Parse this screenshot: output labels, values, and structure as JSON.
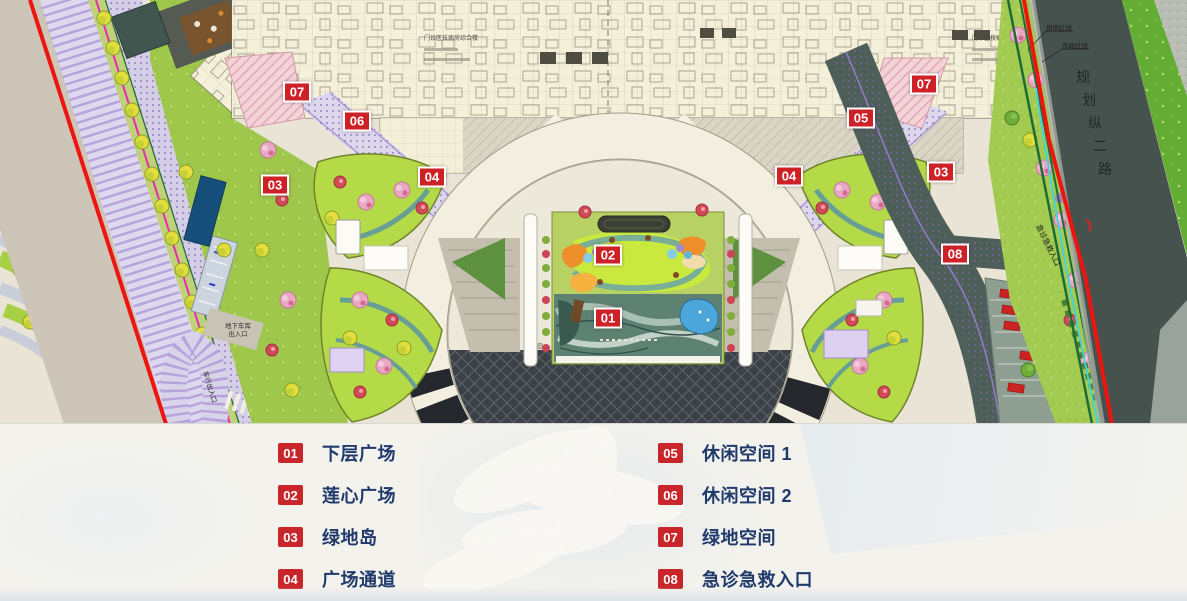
{
  "colors": {
    "marker_red": "#ce2127",
    "legend_chip_red": "#c8262b",
    "legend_text_navy": "#1f3a6b",
    "boundary_red_line": "#ee1410",
    "road_dark_teal": "#46524e",
    "building_cream": "#f4f0da",
    "courtyard_chartreuse": "#c9e93e",
    "ring_panel_black": "#24272b",
    "magenta_line": "#e82bb0",
    "cyan_line": "#3fd4e4"
  },
  "map": {
    "road_right_name": "规划纵二路",
    "boundary_label_land": "用地红线",
    "boundary_label_municipal": "市政红线",
    "garage_label": "地下车库出入口",
    "emergency_entrance_label": "急诊急救入口",
    "vehicle_entrance_label": "车行出入口",
    "logistics_entrance_label": "物流入口",
    "building_annotation_left": "门诊医技病房综合楼",
    "building_annotation_right": "门诊医技病房综合楼",
    "markers": [
      {
        "num": "01",
        "x": 608,
        "y": 318
      },
      {
        "num": "02",
        "x": 608,
        "y": 255
      },
      {
        "num": "03",
        "x": 275,
        "y": 185
      },
      {
        "num": "03",
        "x": 941,
        "y": 172
      },
      {
        "num": "04",
        "x": 432,
        "y": 177
      },
      {
        "num": "04",
        "x": 789,
        "y": 176
      },
      {
        "num": "05",
        "x": 861,
        "y": 118
      },
      {
        "num": "06",
        "x": 357,
        "y": 121
      },
      {
        "num": "07",
        "x": 297,
        "y": 92
      },
      {
        "num": "07",
        "x": 924,
        "y": 84
      },
      {
        "num": "08",
        "x": 955,
        "y": 254
      }
    ]
  },
  "legend": {
    "items": [
      {
        "num": "01",
        "label": "下层广场"
      },
      {
        "num": "02",
        "label": "莲心广场"
      },
      {
        "num": "03",
        "label": "绿地岛"
      },
      {
        "num": "04",
        "label": "广场通道"
      },
      {
        "num": "05",
        "label": "休闲空间 1"
      },
      {
        "num": "06",
        "label": "休闲空间 2"
      },
      {
        "num": "07",
        "label": "绿地空间"
      },
      {
        "num": "08",
        "label": "急诊急救入口"
      }
    ]
  }
}
